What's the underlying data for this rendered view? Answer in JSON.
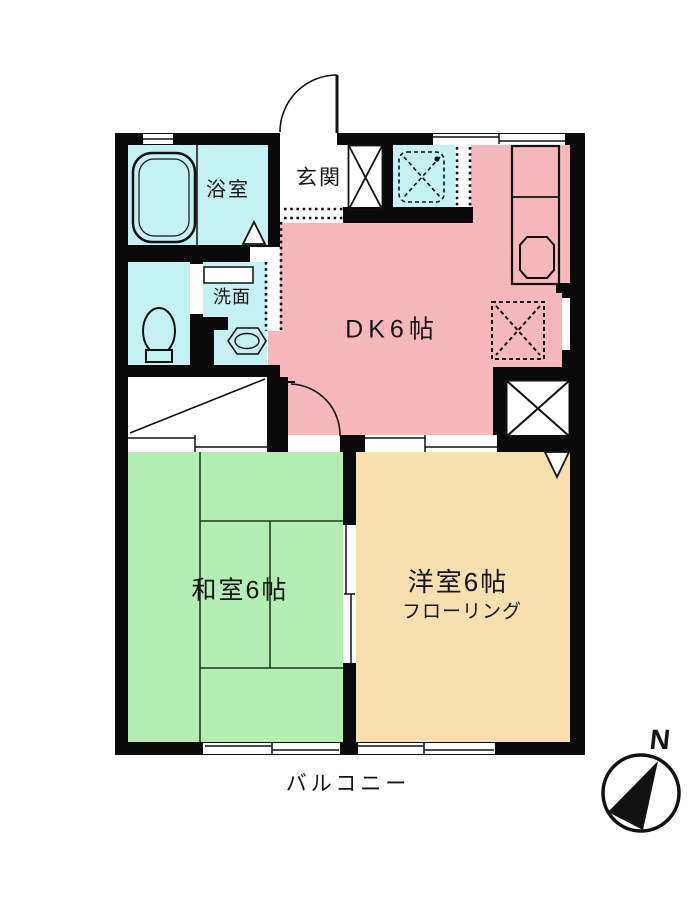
{
  "plan": {
    "rooms": {
      "bathroom": {
        "label": "浴室"
      },
      "washroom": {
        "label": "洗面"
      },
      "entrance": {
        "label": "玄関"
      },
      "dining_kitchen": {
        "label": "DK6帖"
      },
      "japanese_room": {
        "label": "和室6帖"
      },
      "western_room": {
        "label": "洋室6帖",
        "floor_note": "フローリング"
      },
      "balcony": {
        "label": "バルコニー"
      }
    },
    "compass": {
      "north_label": "N"
    },
    "colors": {
      "wet_area": "#c6f1f3",
      "dining_kitchen": "#f6b8bc",
      "japanese_room": "#b5eeb5",
      "western_room": "#f7dfae",
      "wall": "#0a0a0a"
    }
  }
}
